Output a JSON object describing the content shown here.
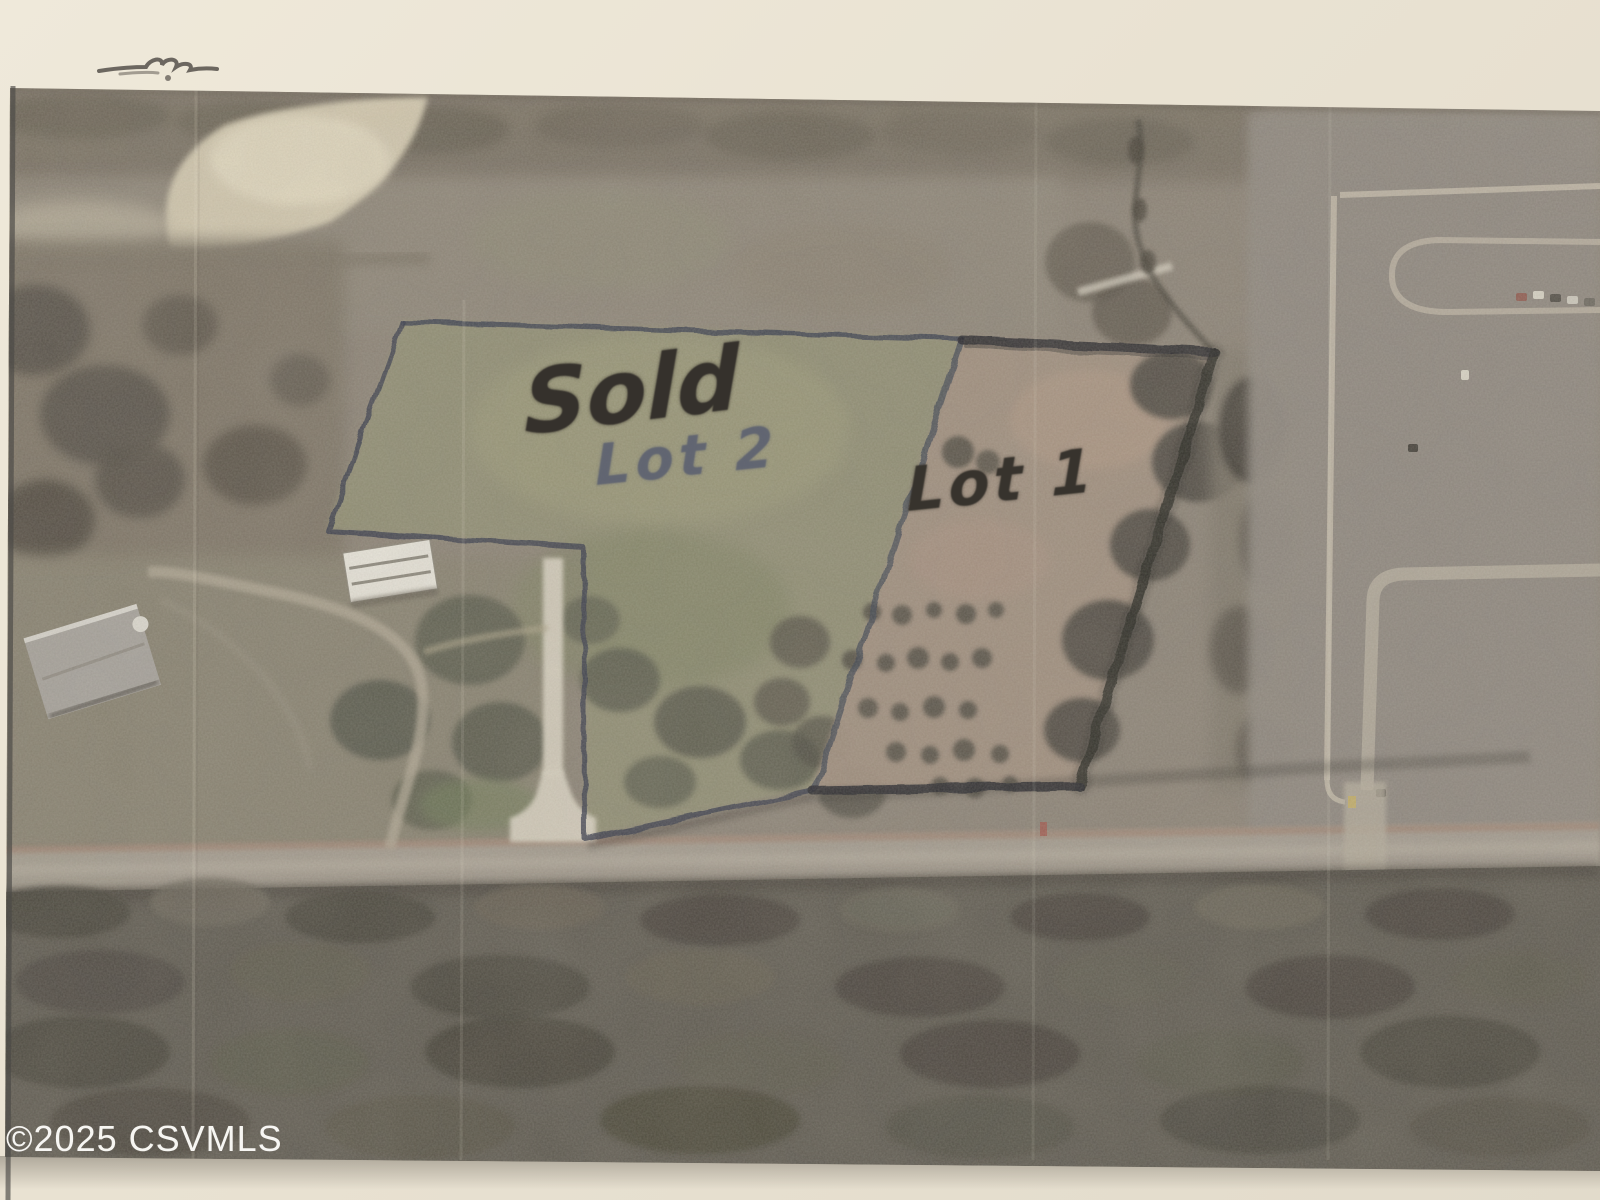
{
  "page": {
    "kind": "scanned aerial plat photograph",
    "paper_color": "#e9e2d2",
    "photo_base_color": "#8b8276",
    "boundary_ink_color": "#2b2e38",
    "heavy_ink_color": "#26262b"
  },
  "watermark": {
    "text": "©2025 CSVMLS",
    "color": "#ffffff"
  },
  "annotations": {
    "sold": {
      "label": "Sold",
      "ink": "#35312c"
    },
    "lot2": {
      "label": "Lot 2",
      "ink": "#5c6070"
    },
    "lot1": {
      "label": "Lot 1",
      "ink": "#37332d"
    }
  },
  "parcels": [
    {
      "name": "Lot 2",
      "note": "Sold"
    },
    {
      "name": "Lot 1",
      "note": ""
    }
  ],
  "marks": [
    {
      "name": "pen-scribble",
      "location": "top-left paper margin"
    }
  ]
}
